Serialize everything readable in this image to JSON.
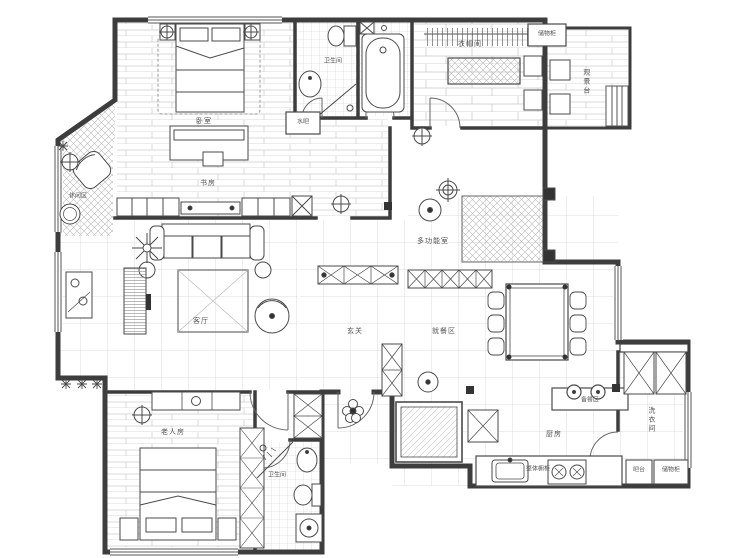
{
  "plan_type": "apartment-floor-plan",
  "colors": {
    "background": "#ffffff",
    "wall": "#3d3d3d",
    "line": "#555555",
    "floor_pattern": "#c9c9c9",
    "label": "#555555"
  },
  "rooms": {
    "master_bedroom": "卧室",
    "study": "书房",
    "leisure_area": "休闲区",
    "bathroom_top": "卫生间",
    "water_bar": "水吧",
    "cloakroom": "衣帽间",
    "storage_cabinet_top": "储物柜",
    "view_deck": "观景台",
    "multi_function_room": "多功能室",
    "living_room": "客厅",
    "foyer": "玄关",
    "dining_area": "就餐区",
    "elder_room": "老人房",
    "bathroom_bottom": "卫生间",
    "prep_area": "备餐区",
    "kitchen": "厨房",
    "laundry_room": "洗衣间",
    "bar_counter": "吧台",
    "storage_cabinet_bottom": "储物柜",
    "cabinet_unit": "整体橱柜"
  }
}
